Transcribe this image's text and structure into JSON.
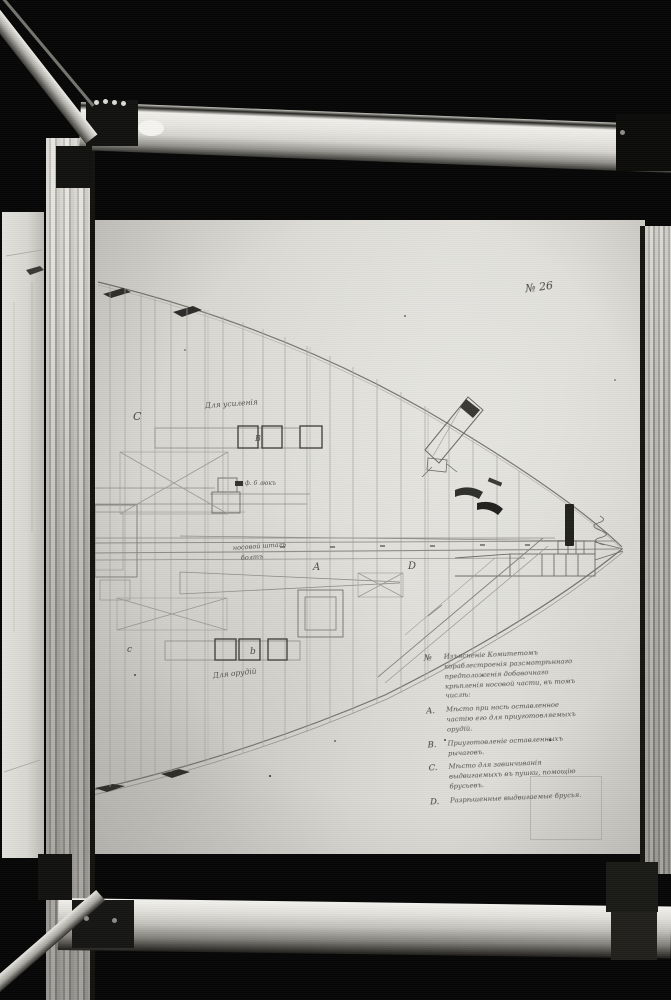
{
  "photo": {
    "background_color": "#070707",
    "paper_color": "#dbdad5",
    "frame_color": "#c9c7c1"
  },
  "document": {
    "sheet_number": "№ 26",
    "plan_letters": {
      "upper_c": "C",
      "upper_b": "B",
      "center_a": "A",
      "center_d": "D",
      "lower_c": "c",
      "lower_b": "b"
    },
    "annotations": {
      "top_label": "Для усиленія",
      "hatch_label": "ф. 6 люкъ",
      "centerline_label_1": "носовой штагъ",
      "centerline_label_2": "болтъ",
      "bottom_label": "Для орудій"
    },
    "legend": {
      "items": [
        {
          "key": "№",
          "text": "Изъясненіе Комитетомъ кораблестроенія разсмотрѣннаго предположенія добавочнаго крѣпленія носовой части, въ томъ числѣ:"
        },
        {
          "key": "A.",
          "text": "Мѣсто при носѣ оставленное частію его для приуготовляемыхъ орудій."
        },
        {
          "key": "B.",
          "text": "Приуготовленіе оставленныхъ рычаговъ."
        },
        {
          "key": "C.",
          "text": "Мѣсто для завинчиванія выдвигаемыхъ въ пушки, помощію брусьевъ."
        },
        {
          "key": "D.",
          "text": "Разрѣшенные выдвигаемые брусья."
        }
      ]
    }
  }
}
